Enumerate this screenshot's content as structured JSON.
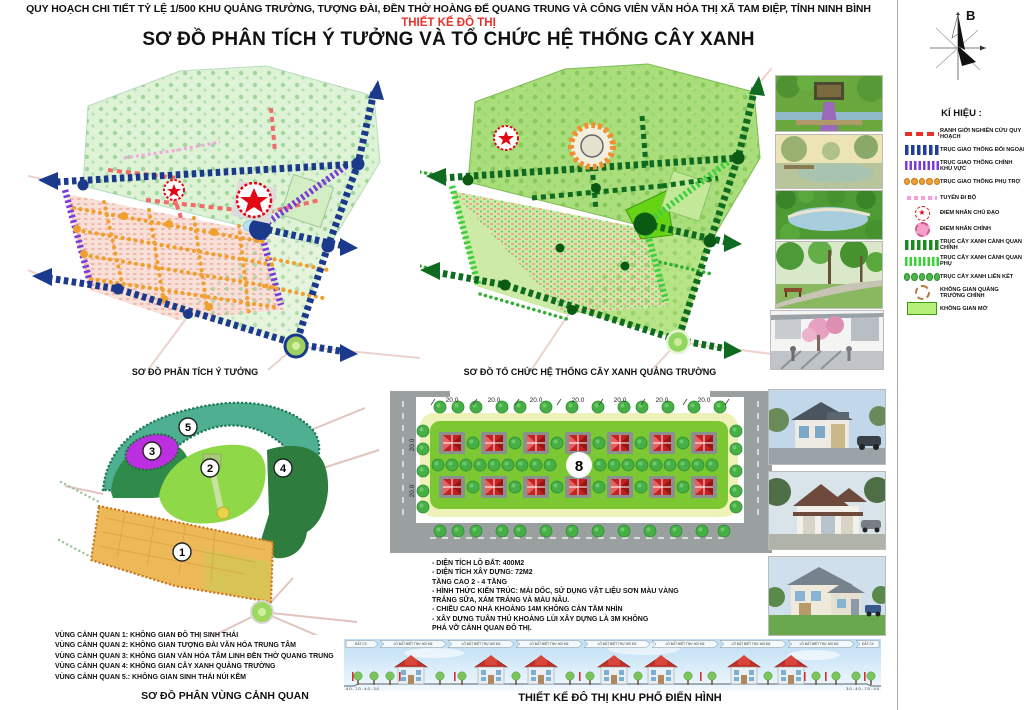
{
  "header": {
    "line1": "QUY HOẠCH CHI TIẾT TỶ LỆ 1/500 KHU QUẢNG TRƯỜNG, TƯỢNG ĐÀI, ĐỀN THỜ HOÀNG ĐẾ QUANG TRUNG VÀ CÔNG VIÊN VĂN HÓA THỊ XÃ TAM ĐIỆP, TỈNH NINH BÌNH",
    "line2": "THIẾT KẾ ĐÔ THỊ",
    "line3": "SƠ ĐỒ PHÂN TÍCH Ý TƯỞNG VÀ TỔ CHỨC HỆ THỐNG CÂY XANH"
  },
  "compass": {
    "north_label": "B"
  },
  "legend": {
    "title": "KÍ HIỆU :",
    "items": [
      {
        "label": "RANH GIỚI NGHIÊN CỨU QUY HOẠCH",
        "symbol": "red-dashed-line",
        "color": "#e8312a"
      },
      {
        "label": "TRỤC GIAO THÔNG ĐỐI NGOẠI",
        "symbol": "blue-thick-dashes",
        "color": "#1f3d99"
      },
      {
        "label": "TRỤC GIAO THÔNG CHÍNH KHU VỰC",
        "symbol": "purple-stripes",
        "color": "#7a3bd6"
      },
      {
        "label": "TRỤC GIAO THÔNG PHỤ TRỢ",
        "symbol": "orange-dots",
        "color": "#f0a030"
      },
      {
        "label": "TUYẾN ĐI BỘ",
        "symbol": "pink-dashes",
        "color": "#f2a0e0"
      },
      {
        "label": "ĐIỂM NHẤN CHỦ ĐẠO",
        "symbol": "red-star-in-dashed-circle",
        "color": "#e30613"
      },
      {
        "label": "ĐIỂM NHẤN CHÍNH",
        "symbol": "pink-circle",
        "color": "#f4a0c8"
      },
      {
        "label": "TRỤC CÂY XANH CẢNH QUAN CHÍNH",
        "symbol": "dark-green-thick-dashes",
        "color": "#1e8a1e"
      },
      {
        "label": "TRỤC CÂY XANH CẢNH QUAN PHỤ",
        "symbol": "green-stripes",
        "color": "#35d435"
      },
      {
        "label": "TRỤC CÂY XANH LIÊN KẾT",
        "symbol": "green-dots",
        "color": "#4cb84c"
      },
      {
        "label": "KHÔNG GIAN QUẢNG TRƯỜNG CHÍNH",
        "symbol": "brown-dashed-ring",
        "color": "#b5793c"
      },
      {
        "label": "KHÔNG GIAN MỞ",
        "symbol": "green-rectangle",
        "color": "#b4f07a"
      }
    ]
  },
  "maps": {
    "concept": {
      "caption": "SƠ ĐỒ PHÂN TÍCH Ý TƯỞNG"
    },
    "green_system": {
      "caption": "SƠ ĐỒ TỔ CHỨC HỆ THỐNG CÂY XANH QUẢNG TRƯỜNG"
    },
    "zones": {
      "caption": "SƠ ĐỒ PHÂN VÙNG CẢNH QUAN",
      "labels": [
        "1",
        "2",
        "3",
        "4",
        "5"
      ],
      "notes": [
        "VÙNG CẢNH QUAN 1: KHÔNG GIAN ĐÔ THỊ SINH THÁI",
        "VÙNG CẢNH QUAN 2: KHÔNG GIAN TƯỢNG ĐÀI VĂN HÓA TRUNG TÂM",
        "VÙNG CẢNH QUAN 3: KHÔNG GIAN VĂN HÓA TÂM LINH ĐỀN THỜ QUANG TRUNG",
        "VÙNG CẢNH QUAN 4: KHÔNG GIAN CÂY XANH QUẢNG TRƯỜNG",
        "VÙNG CẢNH QUAN 5.: KHÔNG GIAN SINH THÁI NÚI KẼM"
      ]
    }
  },
  "site_plan": {
    "dims_top": [
      "20.0",
      "20.0",
      "20.0",
      "20.0",
      "20.0",
      "20.0",
      "20.0"
    ],
    "dims_left": [
      "20.0",
      "20.0"
    ],
    "block_label": "8"
  },
  "specs": {
    "lines": [
      "- DIỆN TÍCH LÔ ĐẤT: 400M2",
      "- DIỆN TÍCH XÂY DỰNG: 72M2",
      "TẦNG CAO 2 - 4 TẦNG",
      "- HÌNH THỨC KIẾN TRÚC: MÁI DỐC, SỬ DỤNG VẬT LIỆU SƠN MÀU VÀNG",
      "TRẮNG SỮA, XÁM TRẮNG VÀ MÀU NÂU.",
      "- CHIỀU CAO NHÀ KHOẢNG 14M KHÔNG CẢN TẦM NHÌN",
      "- XÂY DỰNG TUÂN THỦ KHOẢNG LÙI XÂY DỰNG LÀ 3M KHÔNG",
      "PHÁ VỠ CẢNH QUAN ĐÔ THỊ."
    ]
  },
  "elevation": {
    "caption": "THIẾT KẾ ĐÔ THỊ KHU PHỐ ĐIỂN HÌNH",
    "plot_label": "LÔ ĐẤT BIỆT THỰ 400 M2",
    "end_label": "ĐẤT CX",
    "dims_left": "4.0 - 7.0 - 4.0 - 3.0",
    "dims_right": "3.0 - 4.0 - 7.0 - 4.0"
  }
}
